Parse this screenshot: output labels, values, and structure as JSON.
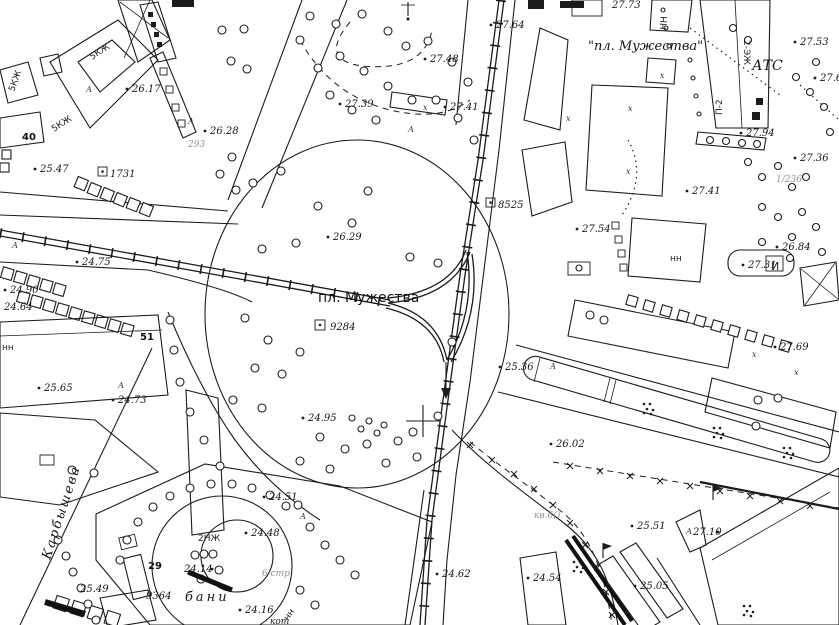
{
  "map": {
    "square_label": "пл. Мужества",
    "metro_station_label": "\"пл. Мужества\"",
    "street_label": "Карбышева",
    "atc_label": "АТС",
    "bani_label": "бани",
    "kot_label": "кот",
    "stroy_label": "6 стр",
    "kvartal_faint_label": "кв.6()",
    "ruins_faint_label": "293",
    "block_faint_label": "1/236"
  },
  "spot_elevations": [
    "26.17",
    "26.28",
    "25.47",
    "24.75",
    "24.90",
    "24.64",
    "25.65",
    "24.73",
    "26.29",
    "24.95",
    "27.39",
    "27.48",
    "27.64",
    "27.41",
    "27.73",
    "27.53",
    "27.6",
    "27.94",
    "27.36",
    "27.41",
    "27.54",
    "26.84",
    "27.31",
    "27.69",
    "25.36",
    "26.02",
    "25.51",
    "27.10",
    "25.05",
    "24.54",
    "24.62",
    "24.51",
    "24.48",
    "25.49",
    "24.14",
    "24.16"
  ],
  "boxed_numbers": [
    "1731",
    "8525",
    "9284",
    "9364"
  ],
  "building_numbers": [
    "40",
    "51",
    "29"
  ],
  "building_types": [
    "5КЖ",
    "5КЖ",
    "5КЖ",
    "2НЖ",
    "НН",
    "нн",
    "нн",
    "2-ЭЖ",
    "П-2",
    "И",
    "нн"
  ],
  "letter_marks": [
    "А",
    "х"
  ]
}
